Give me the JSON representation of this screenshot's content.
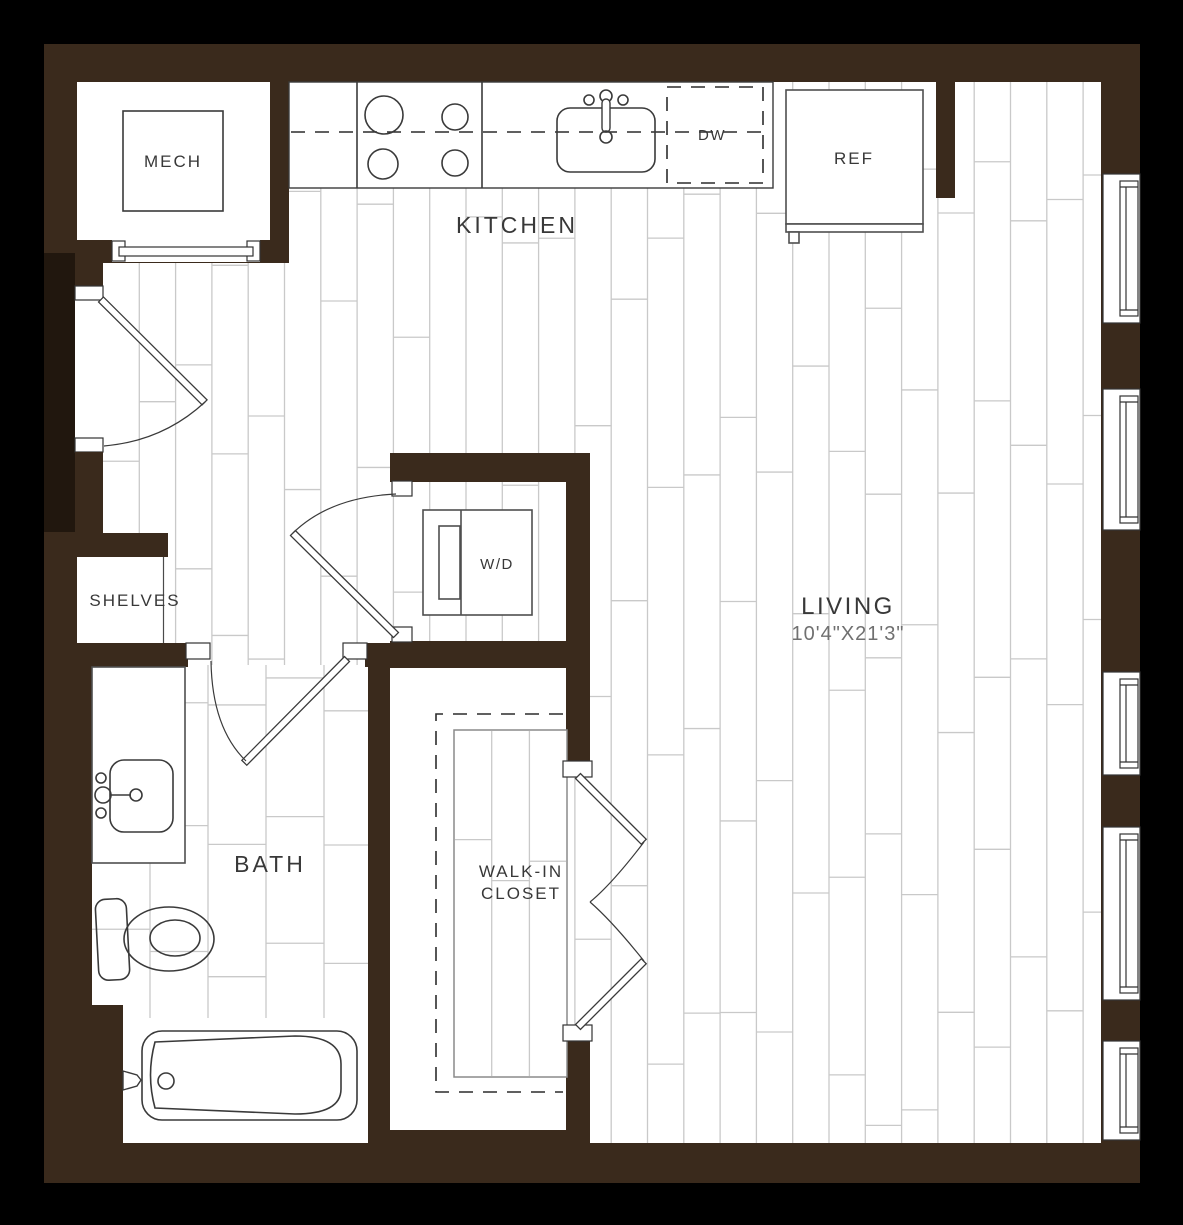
{
  "labels": {
    "mech": "MECH",
    "kitchen": "KITCHEN",
    "dishwasher": "DW",
    "refrigerator": "REF",
    "shelves": "SHELVES",
    "washer_dryer": "W/D",
    "living": "LIVING",
    "living_dimensions": "10'4\"X21'3\"",
    "bath": "BATH",
    "walk_in_closet_line1": "WALK-IN",
    "walk_in_closet_line2": "CLOSET"
  },
  "colors": {
    "background": "#000000",
    "wall": "#3a2a1c",
    "entry_recess": "#21170e",
    "floor": "#ffffff",
    "plank_line": "#c9c9c9",
    "fixture_line": "#3a3a3a",
    "appliance_line": "#4f4f4f",
    "label_text": "#383838",
    "dimension_text": "#707070"
  }
}
